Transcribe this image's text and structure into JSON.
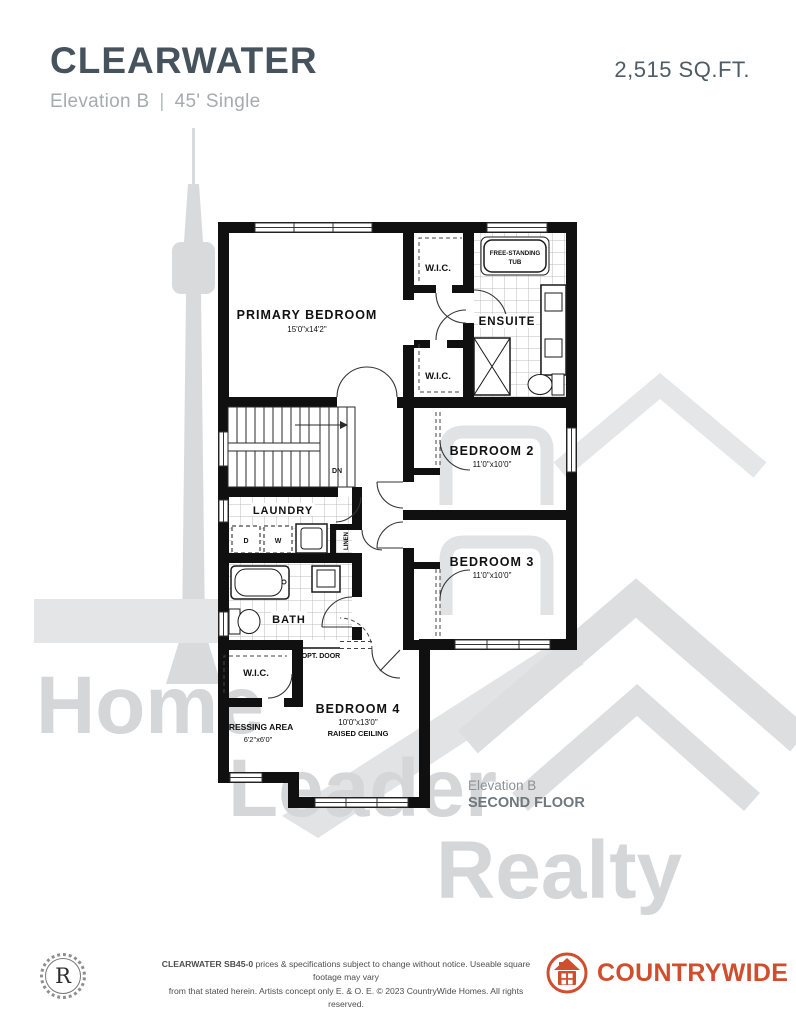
{
  "header": {
    "title": "CLEARWATER",
    "elevation": "Elevation B",
    "separator": "|",
    "model_type": "45' Single",
    "sqft": "2,515 SQ.FT."
  },
  "plan": {
    "primary_bedroom": {
      "name": "PRIMARY BEDROOM",
      "dims": "15'0\"x14'2\""
    },
    "wic_top": {
      "name": "W.I.C."
    },
    "wic_mid": {
      "name": "W.I.C."
    },
    "wic_lower": {
      "name": "W.I.C."
    },
    "ensuite": {
      "name": "ENSUITE"
    },
    "freestanding_tub": {
      "line1": "FREE-STANDING",
      "line2": "TUB"
    },
    "bedroom2": {
      "name": "BEDROOM 2",
      "dims": "11'0\"x10'0\""
    },
    "bedroom3": {
      "name": "BEDROOM 3",
      "dims": "11'0\"x10'0\""
    },
    "bedroom4": {
      "name": "BEDROOM 4",
      "dims": "10'0\"x13'0\"",
      "note": "RAISED CEILING"
    },
    "laundry": {
      "name": "LAUNDRY",
      "dryer": "D",
      "washer": "W"
    },
    "linen": {
      "name": "LINEN"
    },
    "bath": {
      "name": "BATH"
    },
    "opt_door": "OPT. DOOR",
    "stairs_dn": "DN",
    "dressing": {
      "name": "DRESSING AREA",
      "dims": "6'2\"x6'0\""
    },
    "floor_label": {
      "elevation": "Elevation B",
      "floor": "SECOND FLOOR"
    }
  },
  "watermark": {
    "word1": "Home",
    "word2": "Leader",
    "word3": "Realty"
  },
  "footer": {
    "seal_letter": "R",
    "disclaimer_bold": "CLEARWATER SB45-0",
    "disclaimer_rest1": " prices & specifications subject to change without notice. Useable square footage may vary",
    "disclaimer_line2": "from that stated herein. Artists concept only E. & O. E. © 2023 CountryWide Homes. All rights reserved.",
    "brand_normal": "COUNTRY",
    "brand_bold": "WIDE"
  },
  "colors": {
    "title": "#46535d",
    "subtitle": "#a6abb0",
    "brand_orange": "#cf4e2d",
    "wall_black": "#101010",
    "watermark_gray": "#d6d8da"
  }
}
